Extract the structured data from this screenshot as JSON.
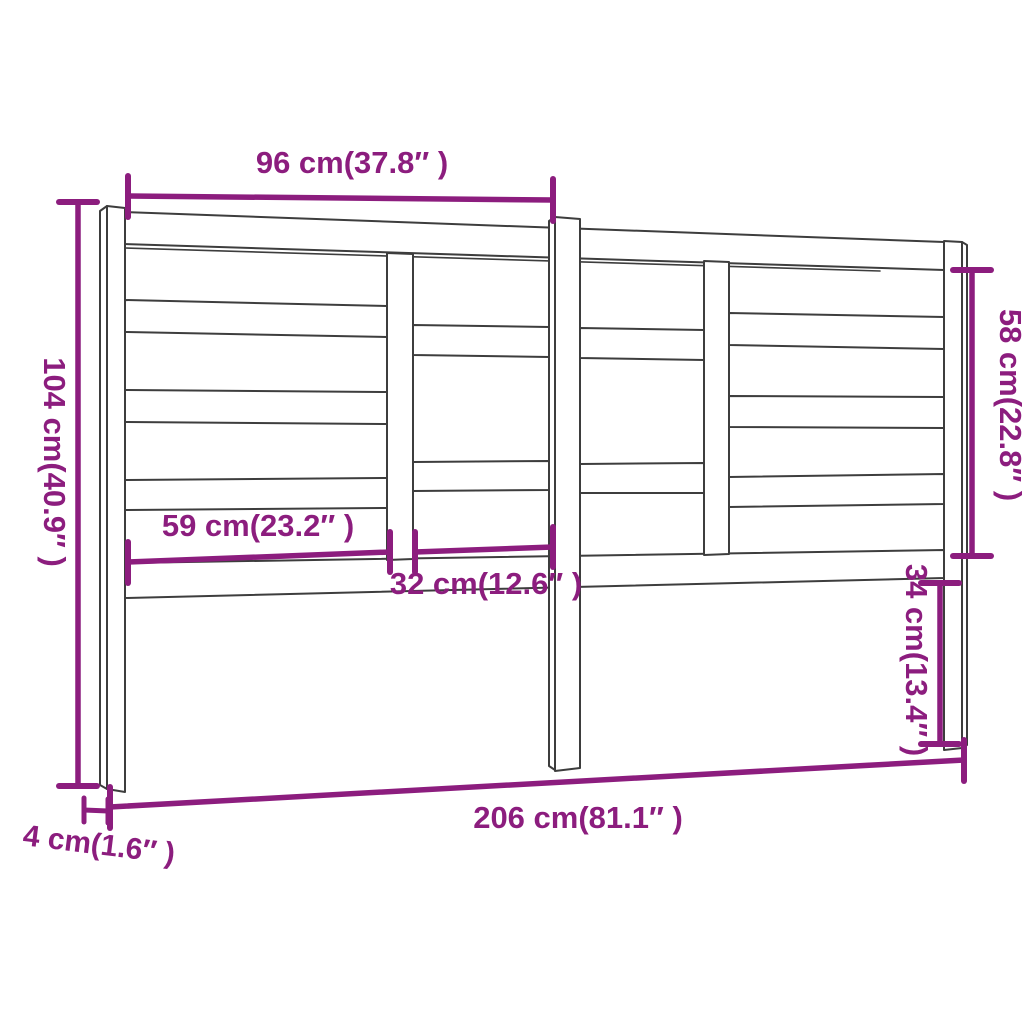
{
  "diagram": {
    "colors": {
      "dimension": "#8c1d7e",
      "line": "#3d3d3d",
      "background": "#ffffff"
    },
    "dimensions": {
      "top_width": "96 cm(37.8″ )",
      "left_height": "104 cm(40.9″ )",
      "right_upper_height": "58 cm(22.8″ )",
      "left_slat_width": "59 cm(23.2″ )",
      "middle_slat_width": "32 cm(12.6″ )",
      "right_lower_height": "34 cm(13.4″ )",
      "total_width": "206 cm(81.1″ )",
      "leg_depth": "4 cm(1.6″ )"
    }
  }
}
